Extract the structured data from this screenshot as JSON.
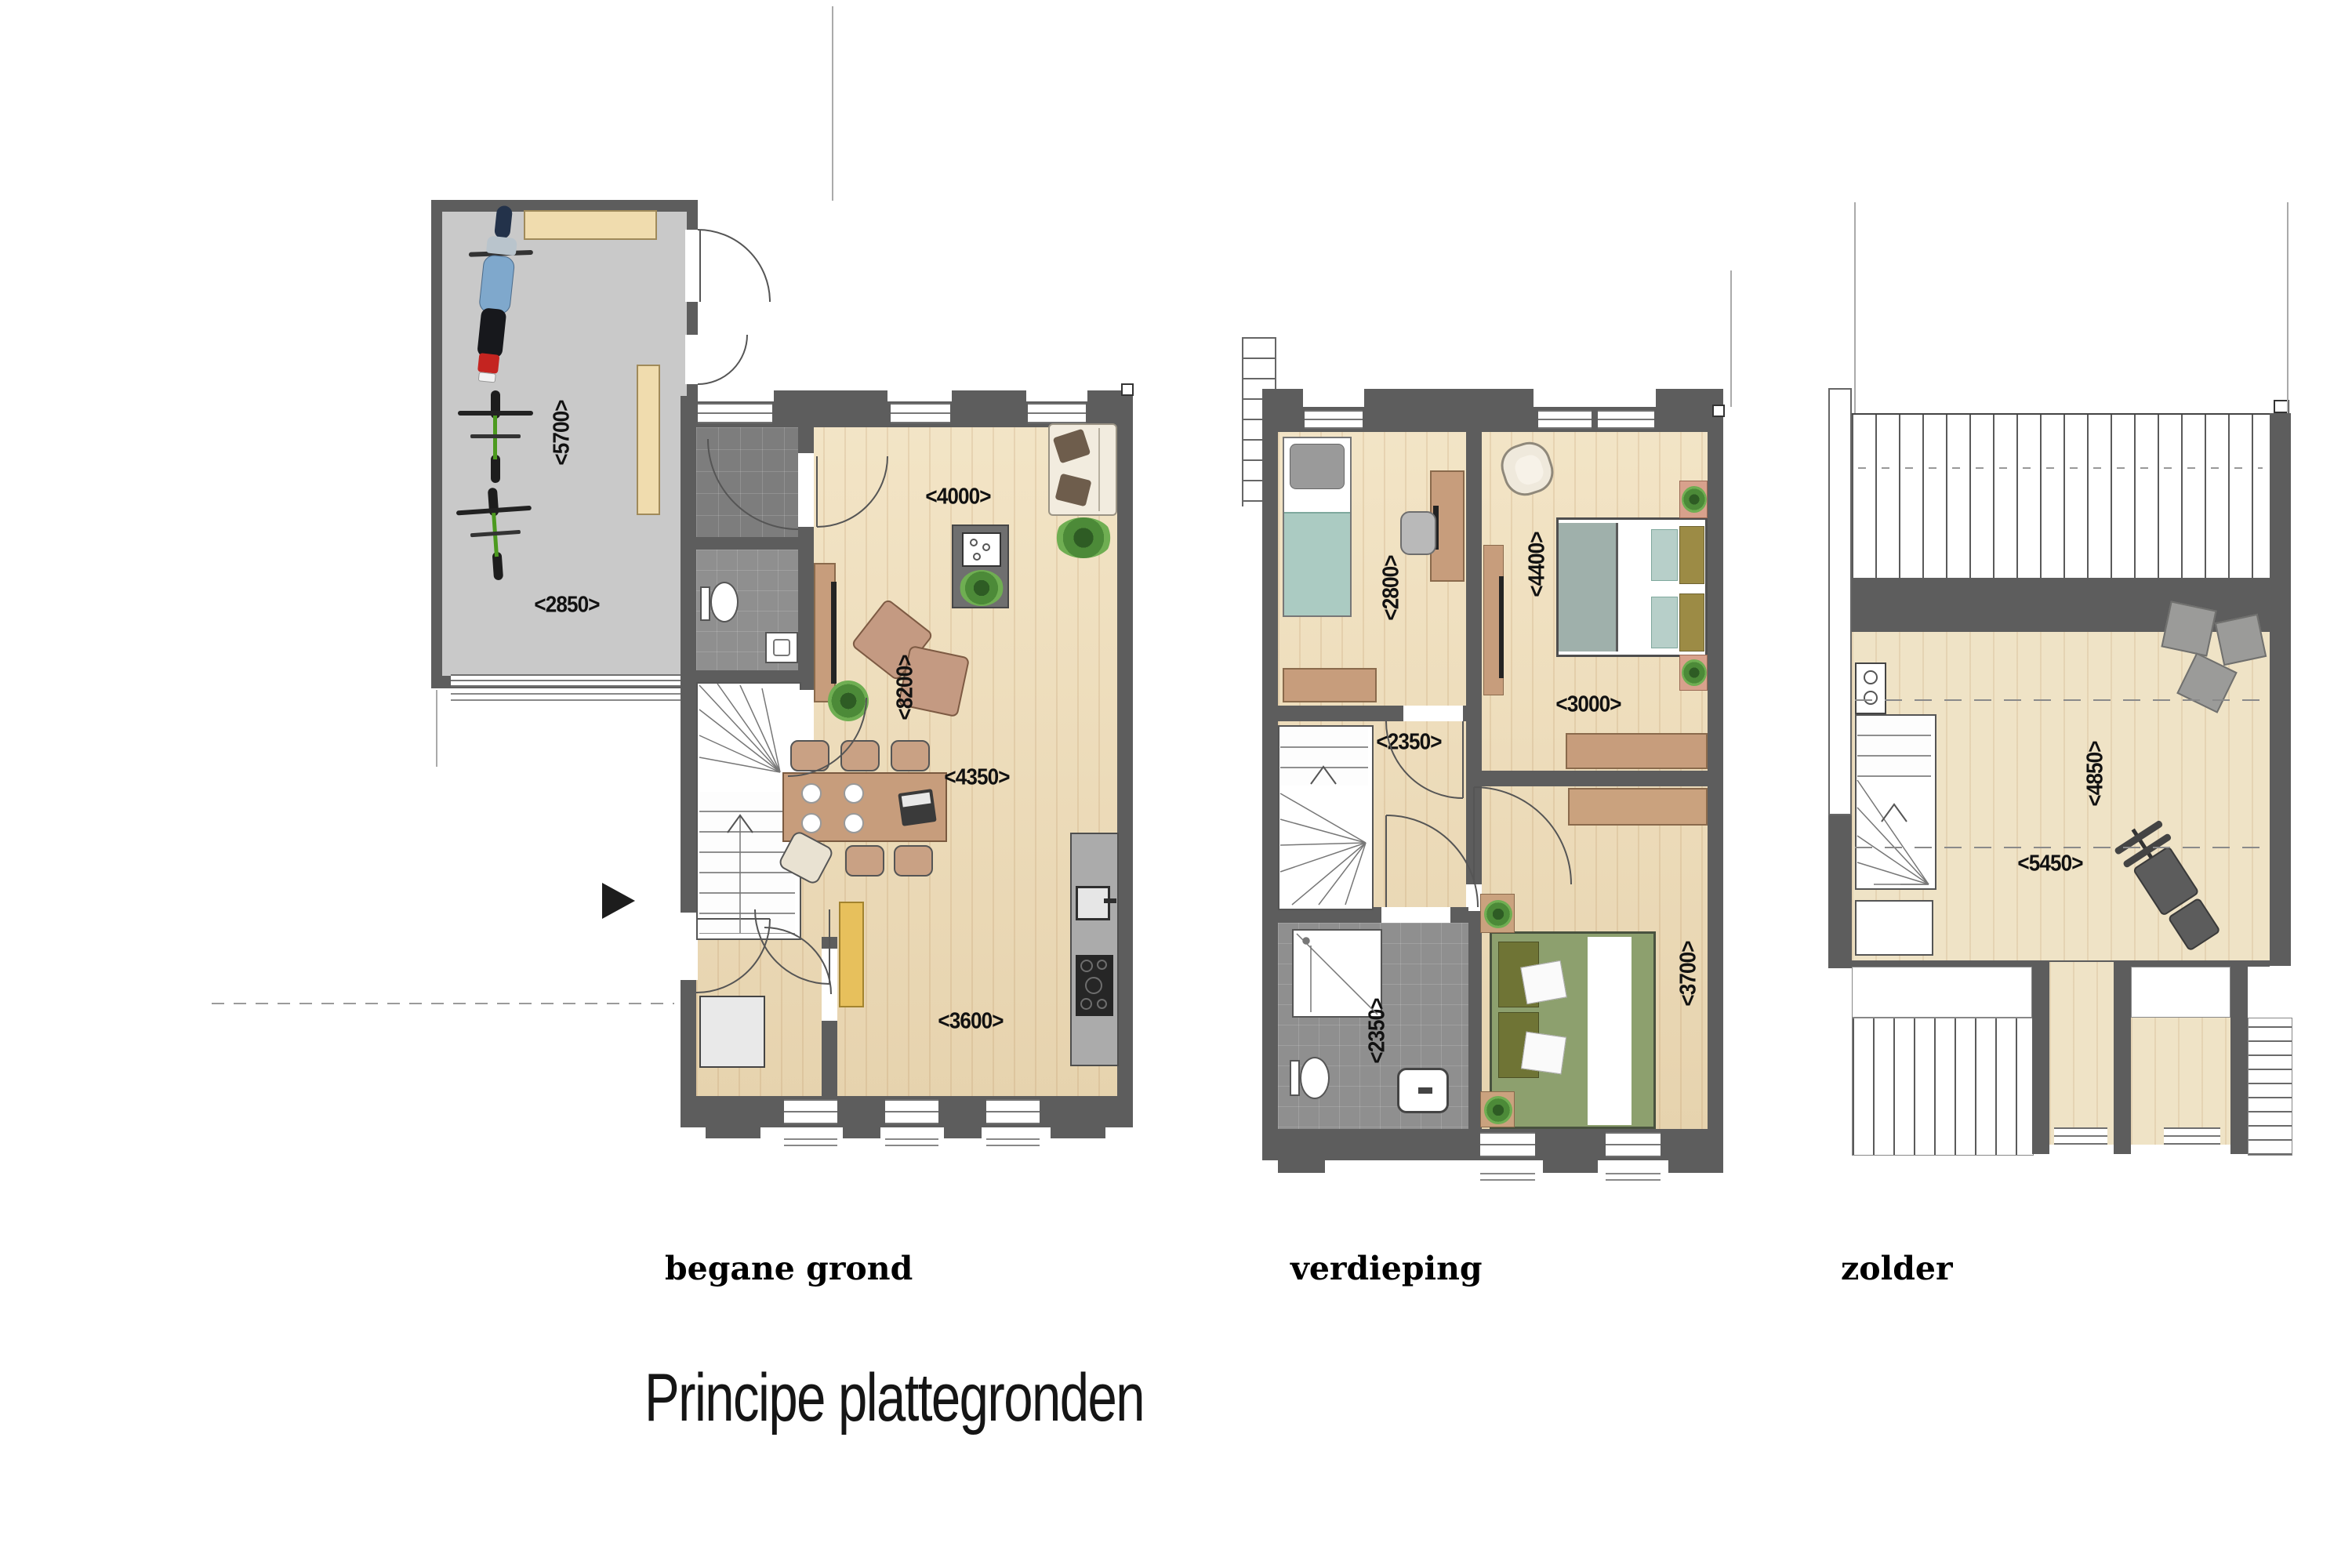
{
  "title": "Principe plattegronden",
  "plans": {
    "bg": {
      "label": "begane grond",
      "rooms": [
        "garage",
        "vestibule",
        "toilet",
        "hal",
        "woonkamer",
        "keuken"
      ],
      "dims": [
        "<5700>",
        "<2850>",
        "<4000>",
        "<8200>",
        "<4350>",
        "<3600>"
      ]
    },
    "v": {
      "label": "verdieping",
      "rooms": [
        "slaapkamer 1",
        "slaapkamer 2",
        "overloop",
        "badkamer",
        "slaapkamer 3"
      ],
      "dims": [
        "<2800>",
        "<4400>",
        "<2350>",
        "<3000>",
        "<2350>",
        "<3700>"
      ]
    },
    "z": {
      "label": "zolder",
      "rooms": [
        "zolder"
      ],
      "dims": [
        "<4850>",
        "<5450>"
      ]
    }
  },
  "colors": {
    "wall": "#5d5d5d",
    "wood_floor": "#ecdcba",
    "garage_floor": "#c9c9c9",
    "tile_dark": "#7d7d7d",
    "tile_light": "#8f8f8f",
    "counter_gray": "#ababab",
    "furniture_wood": "#c79d7c",
    "light_wood": "#f0dcae",
    "bed_teal": "#abcbc2",
    "bed_green": "#8da06e",
    "pillow_olive": "#9c8b45",
    "sofa_cream": "#f2ecdf",
    "chair_tan": "#c49a82",
    "plant_green": "#48792f",
    "cabinet_yellow": "#e7c05c"
  }
}
